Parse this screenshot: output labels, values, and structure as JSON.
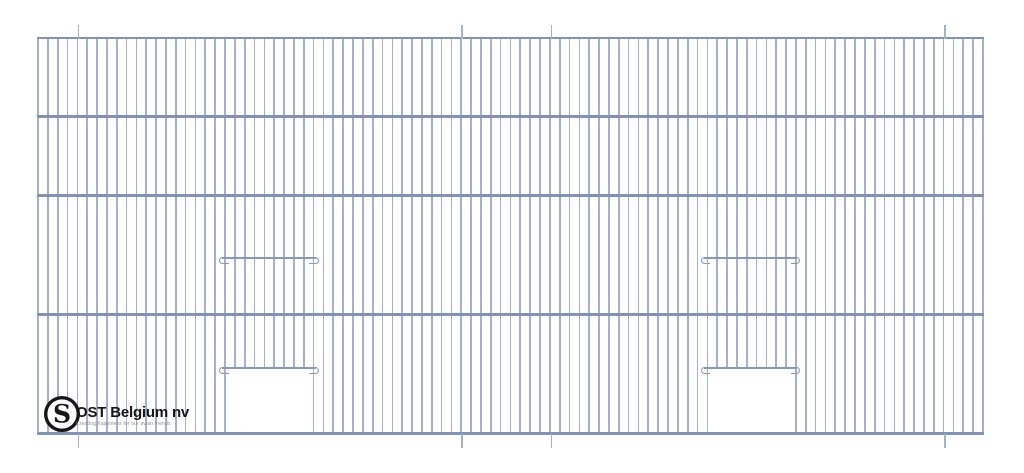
{
  "drawing": {
    "canvas": {
      "width": 1024,
      "height": 473,
      "background": "#ffffff"
    },
    "colors": {
      "wire": "#a6b1c9",
      "bar": "#8593b3",
      "rail": "#8a97b7",
      "tick": "#a6b1c9",
      "cut": "#ffffff"
    },
    "panel": {
      "left": 38,
      "right": 983,
      "top": 38,
      "bottom": 433.6,
      "wire_count": 97,
      "wire_width": 1.7,
      "bar_thickness": 2.6,
      "bar_ys": [
        38,
        116.5,
        195.3,
        314.5,
        433.6
      ]
    },
    "ticks": {
      "xs": [
        78.5,
        462,
        551.5,
        945
      ],
      "top_y": 25,
      "top_h": 13.5,
      "bottom_y": 433.6,
      "bottom_h": 14,
      "width": 1.4
    },
    "rail_thickness": 1.7,
    "hook": {
      "w": 9.5,
      "h": 7.5,
      "bw": 1.5
    },
    "doors": [
      {
        "name": "left-door",
        "rail_x1": 219,
        "rail_x2": 318.5,
        "upper_rail_y": 258,
        "lower_rail_y": 368,
        "cut_x": 226.3,
        "cut_y": 369,
        "cut_w": 86.5,
        "cut_h": 63
      },
      {
        "name": "right-door",
        "rail_x1": 700.5,
        "rail_x2": 800,
        "upper_rail_y": 258,
        "lower_rail_y": 368,
        "cut_x": 708.7,
        "cut_y": 369,
        "cut_w": 86.5,
        "cut_h": 63
      }
    ]
  },
  "logo": {
    "mark": "S",
    "company": "OST Belgium nv",
    "tagline": "Creating happiness for our avian friends"
  }
}
